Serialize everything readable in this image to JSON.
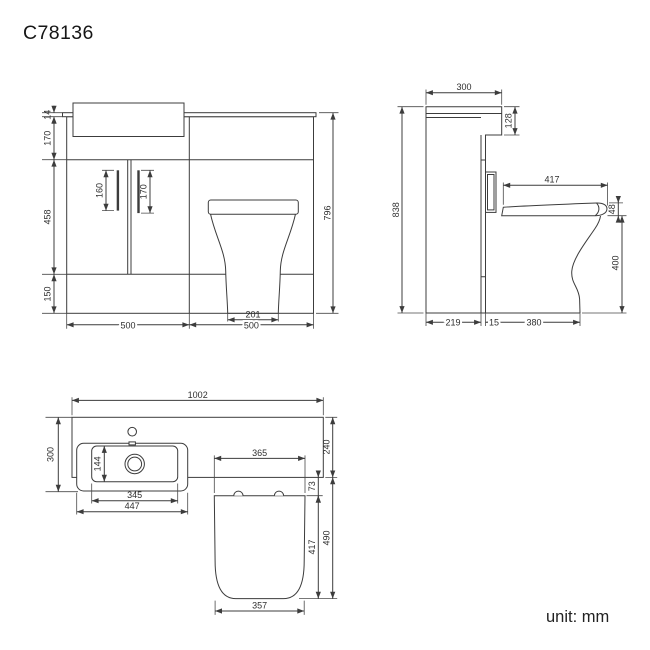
{
  "title": "C78136",
  "unit_label": "unit: mm",
  "colors": {
    "line": "#3c3c3c",
    "text": "#2f2f2f",
    "background": "#ffffff"
  },
  "views": {
    "front": {
      "dims": {
        "countertop_thickness": "14",
        "upper_section_height": "170",
        "door_section_height": "458",
        "plinth_height": "150",
        "left_handle_length": "160",
        "right_handle_length": "170",
        "overall_height": "796",
        "pan_base_width": "201",
        "vanity_width": "500",
        "wc_unit_width": "500"
      }
    },
    "side": {
      "dims": {
        "top_depth": "300",
        "top_section_height": "128",
        "seat_length": "417",
        "seat_thickness": "48",
        "overall_height": "838",
        "pan_front_height": "400",
        "cabinet_depth": "219",
        "panel_gap": "15",
        "pan_projection": "380"
      }
    },
    "plan": {
      "dims": {
        "overall_width": "1002",
        "basin_section_depth": "300",
        "bowl_inner_depth": "144",
        "bowl_inner_width": "345",
        "basin_width": "447",
        "seat_hinge_width": "365",
        "hinge_setback": "73",
        "seat_length": "417",
        "seat_projection": "490",
        "counter_depth": "240",
        "seat_front_width": "357"
      }
    }
  }
}
